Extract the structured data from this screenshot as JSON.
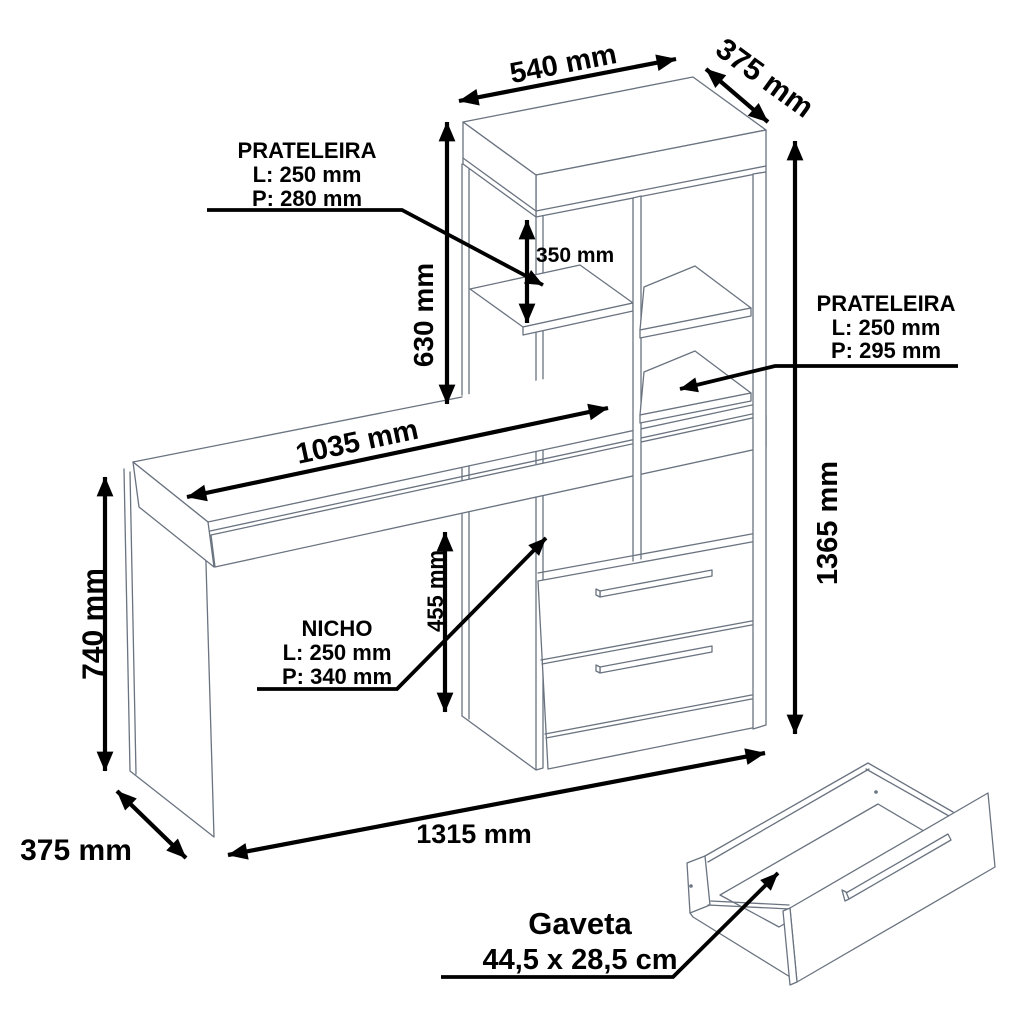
{
  "diagram": {
    "type": "furniture-technical-drawing",
    "product": "desk-with-shelving-unit",
    "units": "mm",
    "colors": {
      "outline": "#6a7380",
      "dimension": "#000000",
      "background": "#ffffff"
    },
    "dimensions": {
      "top_width": "540 mm",
      "top_depth": "375 mm",
      "upper_section_height": "630 mm",
      "shelf_clearance": "350 mm",
      "desk_length": "1035 mm",
      "desk_height": "740 mm",
      "desk_depth": "375 mm",
      "niche_height": "455 mm",
      "total_height": "1365 mm",
      "total_length": "1315 mm"
    },
    "callouts": {
      "shelf_left": {
        "title": "PRATELEIRA",
        "length": "L: 250 mm",
        "depth": "P: 280 mm"
      },
      "shelf_right": {
        "title": "PRATELEIRA",
        "length": "L: 250 mm",
        "depth": "P: 295 mm"
      },
      "niche": {
        "title": "NICHO",
        "length": "L: 250 mm",
        "depth": "P: 340 mm"
      },
      "drawer": {
        "title": "Gaveta",
        "size": "44,5 x 28,5 cm"
      }
    }
  }
}
